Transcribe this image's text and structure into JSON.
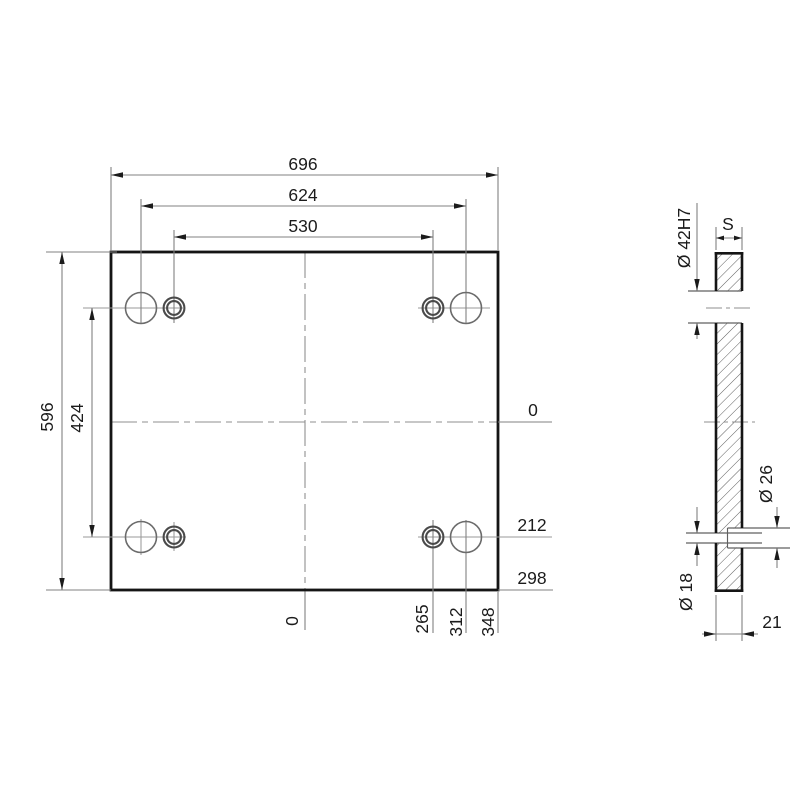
{
  "drawing": {
    "front_view": {
      "dim_width_outer": "696",
      "dim_width_large_holes": "624",
      "dim_width_small_holes": "530",
      "dim_height_outer": "596",
      "dim_height_holes": "424",
      "datum_x_zero": "0",
      "dim_x_small_hole": "265",
      "dim_x_large_hole": "312",
      "dim_x_edge": "348",
      "datum_y_zero": "0",
      "dim_y_hole": "212",
      "dim_y_edge": "298"
    },
    "side_view": {
      "thickness_symbol": "S",
      "dim_bore": "Ø 42H7",
      "dim_counterbore": "Ø 26",
      "dim_through_hole": "Ø 18",
      "dim_thickness": "21"
    },
    "colors": {
      "ink": "#1b1b1b",
      "outline": "#151515",
      "dim_line": "#828282"
    }
  }
}
